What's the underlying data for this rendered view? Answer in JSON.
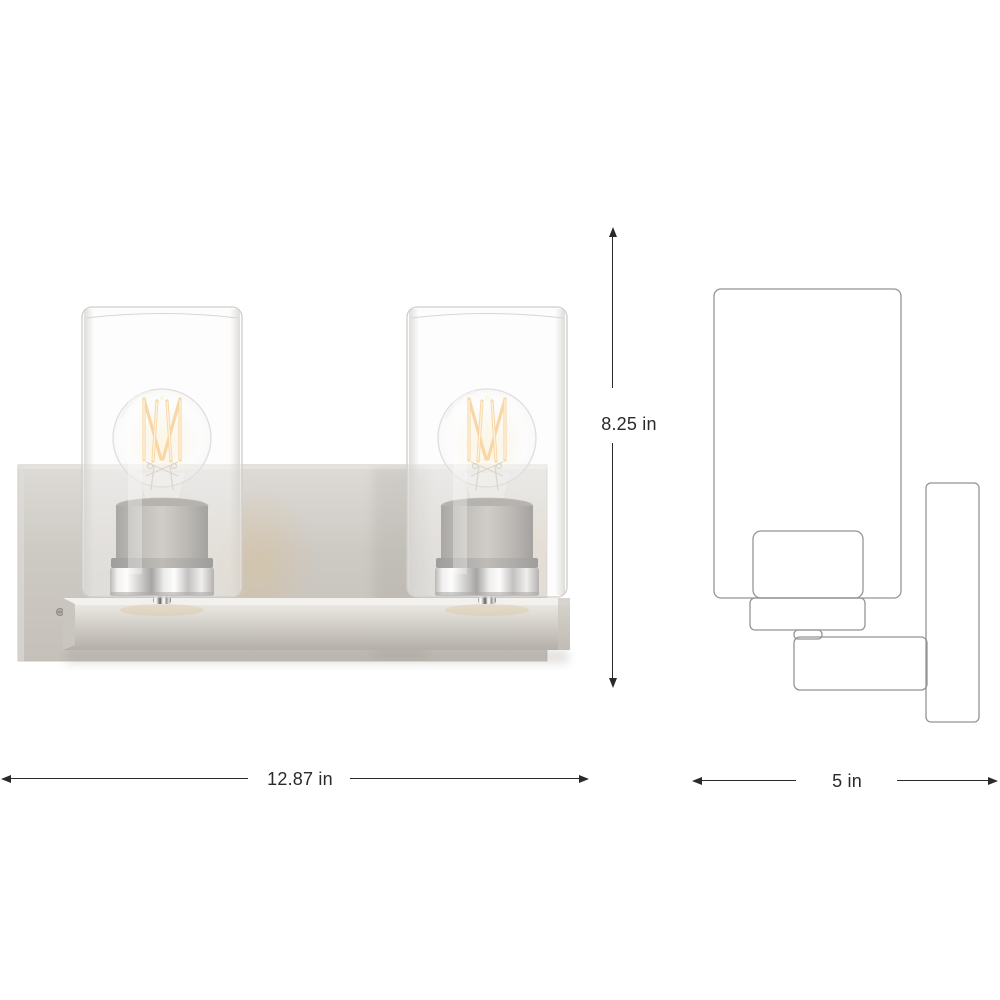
{
  "page": {
    "background_color": "#ffffff",
    "content_type": "product dimension diagram"
  },
  "product": {
    "front_view": "two-light bath vanity fixture photo: brushed nickel backplate and shelf, two clear glass cylinder shades with lit filament bulbs",
    "side_view": "outline line drawing of the fixture profile (shade, socket, arm, wall plate)"
  },
  "dimensions": {
    "height": {
      "label": "8.25 in"
    },
    "width": {
      "label": "12.87 in"
    },
    "depth": {
      "label": "5 in"
    }
  },
  "colors": {
    "dimension_annotation": "#2a2a2a",
    "drawing_outline": "#949494",
    "brushed_nickel": "#cdc9c3",
    "chrome_accent": "#f5f4f2",
    "filament_glow": "#f6b85a"
  }
}
